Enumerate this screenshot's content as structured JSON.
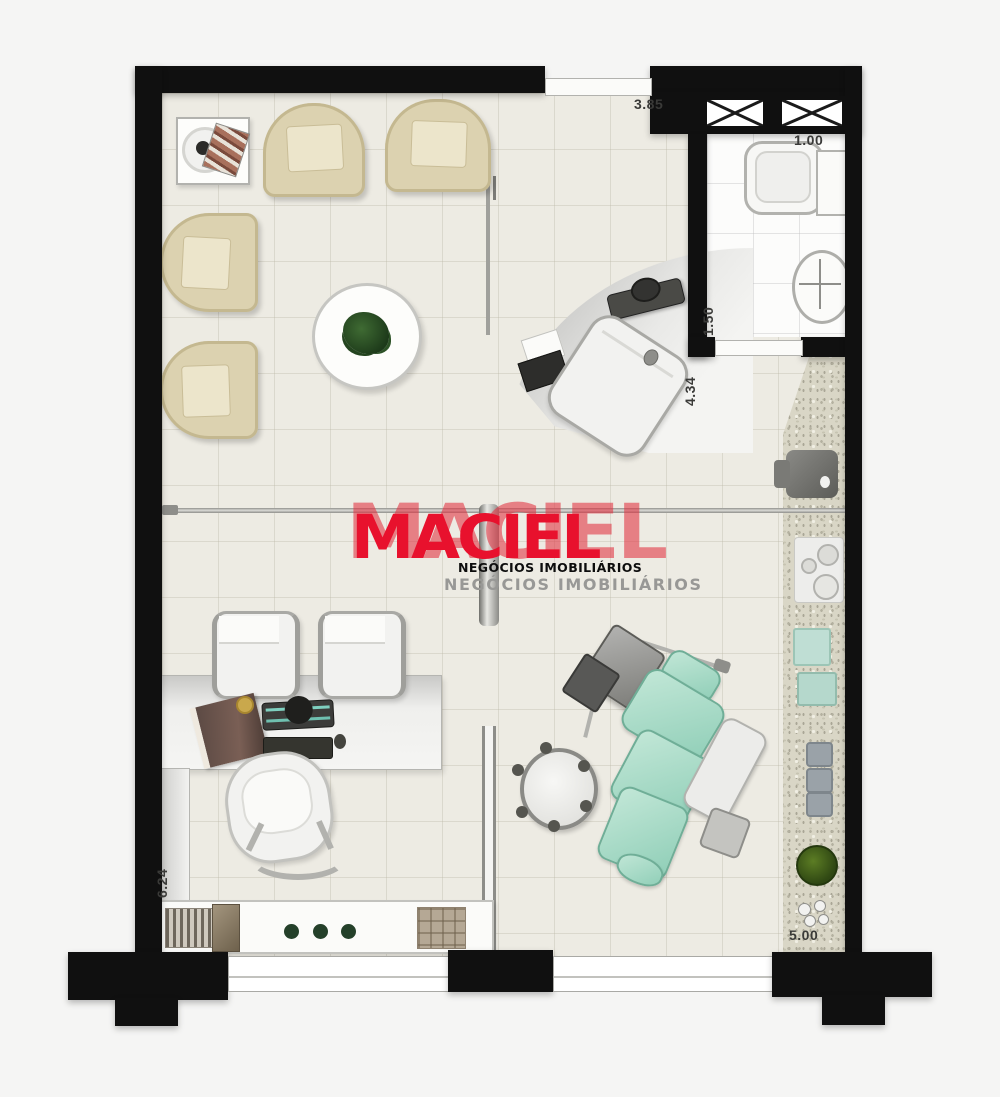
{
  "watermark": {
    "brand_front": "MACIEL",
    "brand_back": "MACIEL",
    "tagline_small": "NEGÓCIOS IMOBILIÁRIOS",
    "tagline_large": "NEGÓCIOS IMOBILIÁRIOS",
    "brand_color": "#e8112d",
    "brand_back_color": "rgba(226,48,64,0.6)"
  },
  "dimensions": {
    "reception_width": "3.85",
    "bathroom_width": "1.00",
    "bathroom_depth": "1.50",
    "hall_depth": "4.34",
    "office_depth": "6.24",
    "treatment_width": "5.00"
  },
  "colors": {
    "wall": "#101010",
    "floor": "#edebe3",
    "bathroom_floor": "#fcfcfb",
    "granite_counter": "#d9d6c6",
    "armchair_beige": "#dcd2b0",
    "dental_chair_teal": "#a5dac6",
    "logo_red": "#e8112d"
  },
  "furniture_icons": [
    "waiting-armchair",
    "side-table",
    "coffee-table-plant",
    "reception-desk",
    "reception-phone",
    "reception-laptop",
    "reception-chair",
    "glass-partition",
    "office-desk",
    "guest-chair",
    "office-chair",
    "desk-book",
    "desk-monitor",
    "desk-keyboard",
    "desk-mouse",
    "credenza-shelf",
    "dental-chair",
    "dental-equipment-cart",
    "dental-stool",
    "spittoon-unit",
    "granite-counter",
    "sterilizer",
    "cooktop-trays",
    "counter-plant",
    "bathroom-sink",
    "bathroom-toilet",
    "vent-shaft",
    "window",
    "entrance-door"
  ]
}
